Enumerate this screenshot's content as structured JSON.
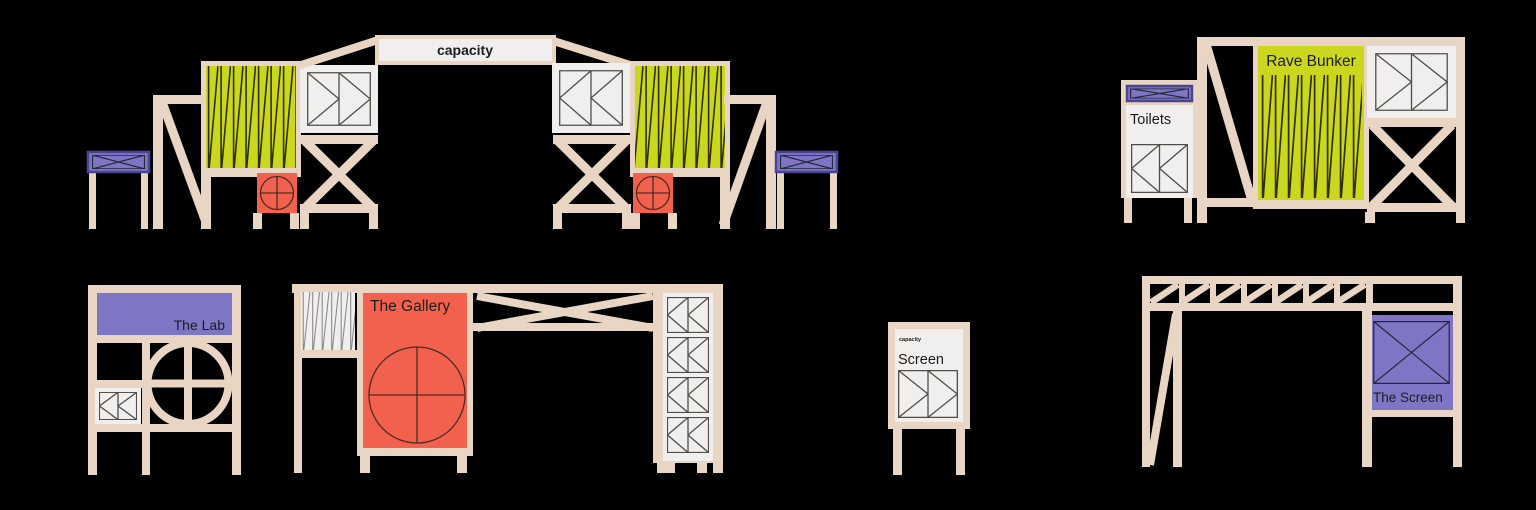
{
  "canvas": {
    "width": 1536,
    "height": 510,
    "background": "#000000"
  },
  "palette": {
    "frame_tan": "#e8d5c3",
    "lime": "#cbd61f",
    "coral_red": "#f2614d",
    "purple": "#7e76c5",
    "purple_border": "#4b4396",
    "panel_white": "#f1efed",
    "ink": "#1c1c1c"
  },
  "structures": {
    "entrance_arch": {
      "banner": "capacity"
    },
    "rave_bunker": {
      "title": "Rave Bunker",
      "toilets": "Toilets"
    },
    "the_lab": {
      "title": "The Lab"
    },
    "the_gallery": {
      "title": "The Gallery"
    },
    "screen_sign": {
      "brand": "capacity",
      "title": "Screen"
    },
    "the_screen": {
      "title": "The Screen"
    }
  }
}
